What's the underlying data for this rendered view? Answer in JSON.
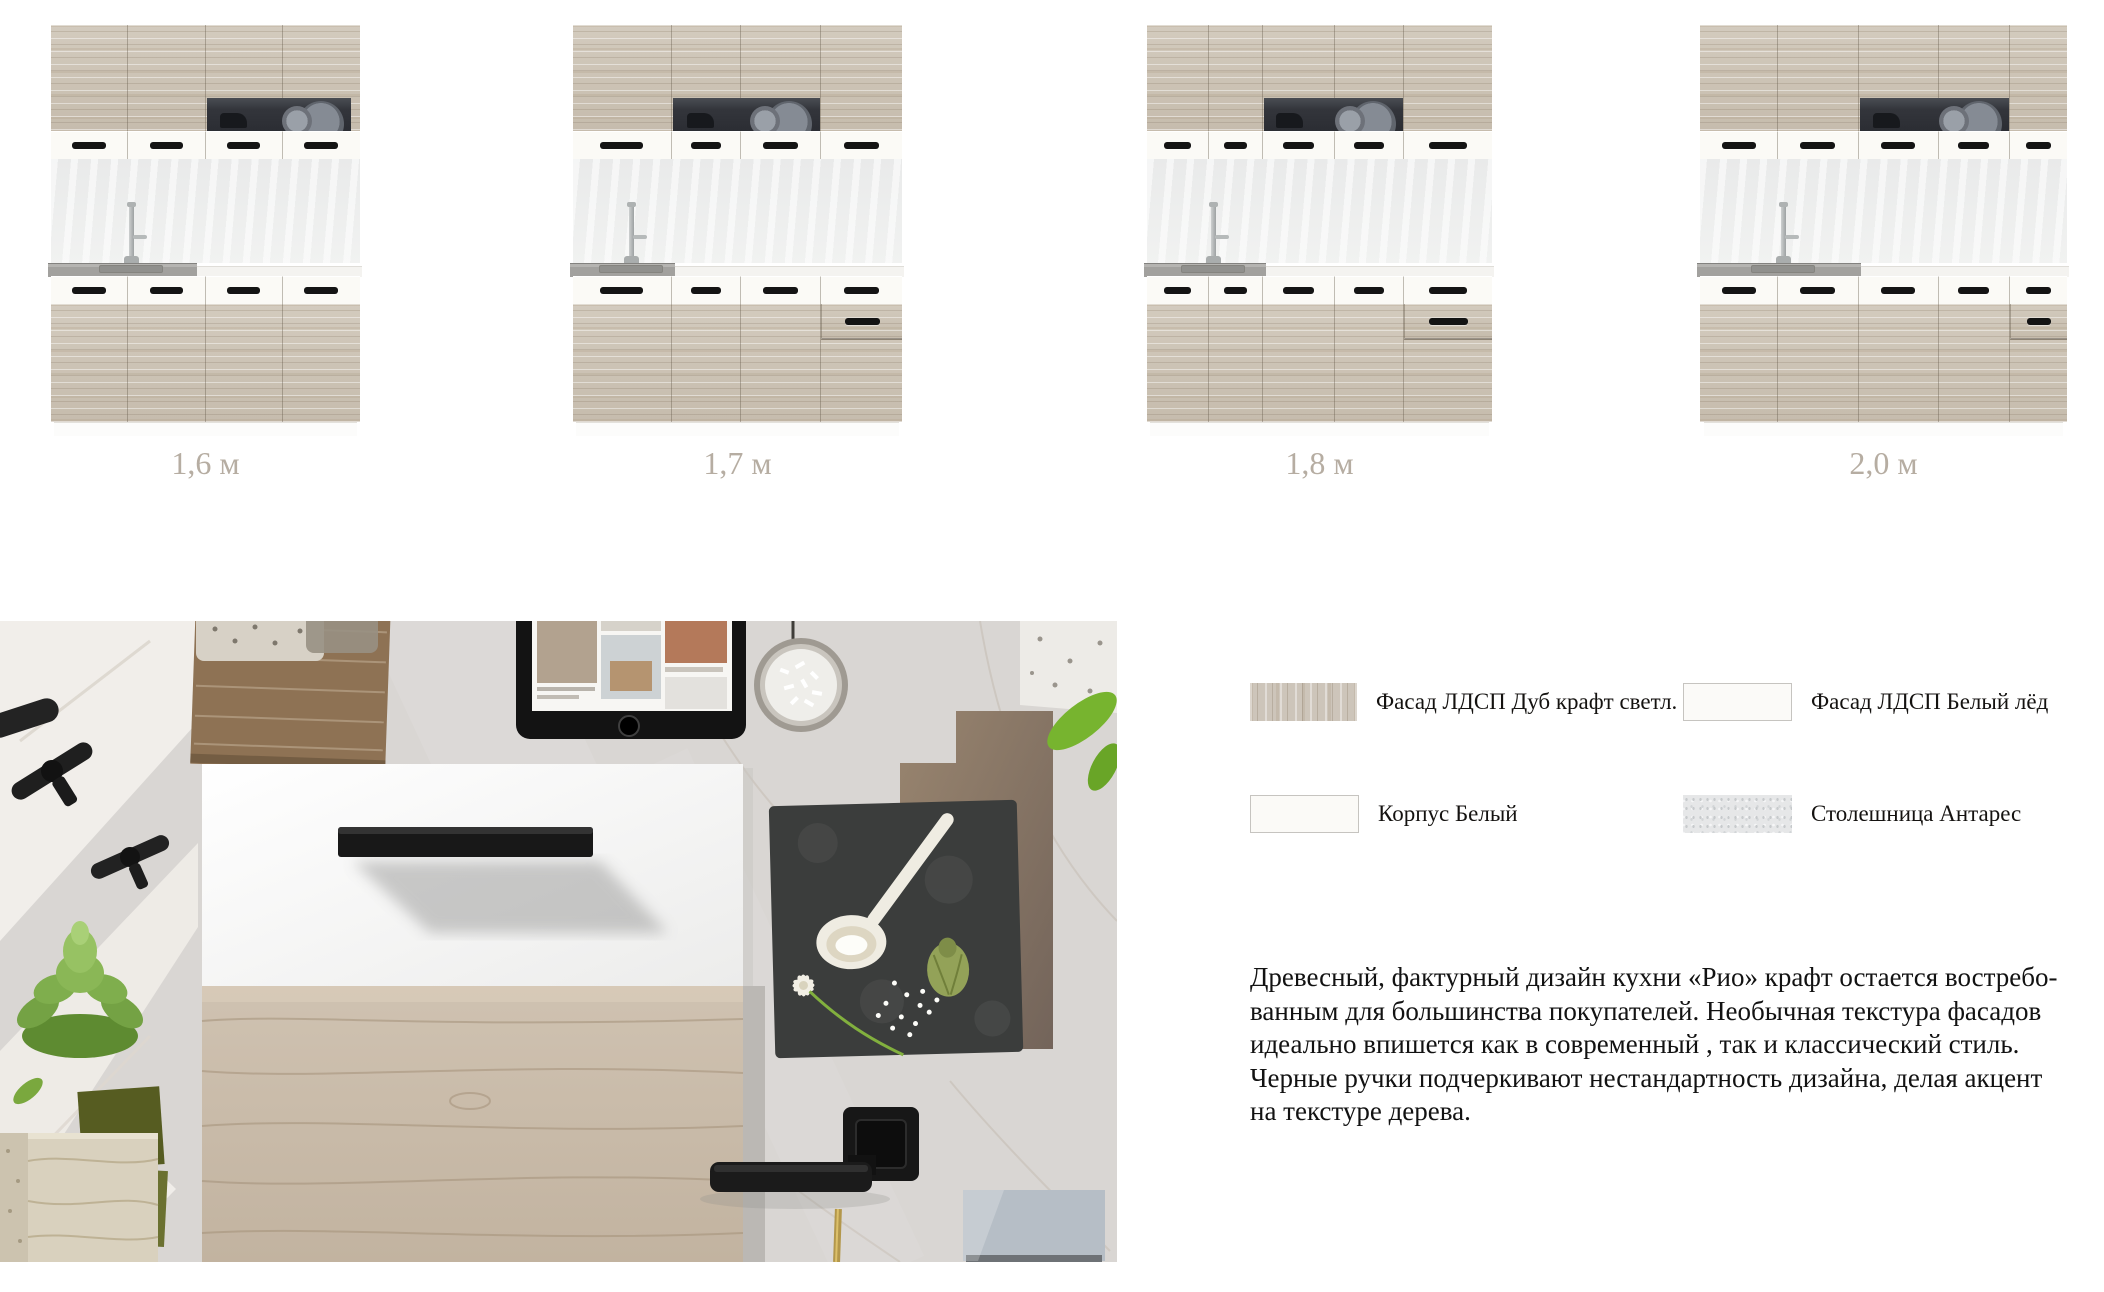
{
  "kitchens": {
    "caption_color": "#b6ada2",
    "items": [
      {
        "label": "1,6 м"
      },
      {
        "label": "1,7 м"
      },
      {
        "label": "1,8 м"
      },
      {
        "label": "2,0 м"
      }
    ]
  },
  "materials": {
    "items": [
      {
        "label": "Фасад ЛДСП Дуб крафт светл.",
        "fill": "#cdc5ba"
      },
      {
        "label": "Фасад ЛДСП Белый лёд",
        "fill": "#fbfaf8"
      },
      {
        "label": "Корпус Белый",
        "fill": "#fbfaf7"
      },
      {
        "label": "Столешница Антарес",
        "fill": "#e6e7e8"
      }
    ]
  },
  "description": {
    "text": "Древесный, фактурный дизайн кухни «Рио» крафт остается востребо-\nванным для большинства покупателей. Необычная текстура фасадов\nидеально впишется как в современный , так и классический стиль.\nЧерные ручки подчеркивают нестандартность  дизайна, делая акцент\nна текстуре дерева."
  }
}
